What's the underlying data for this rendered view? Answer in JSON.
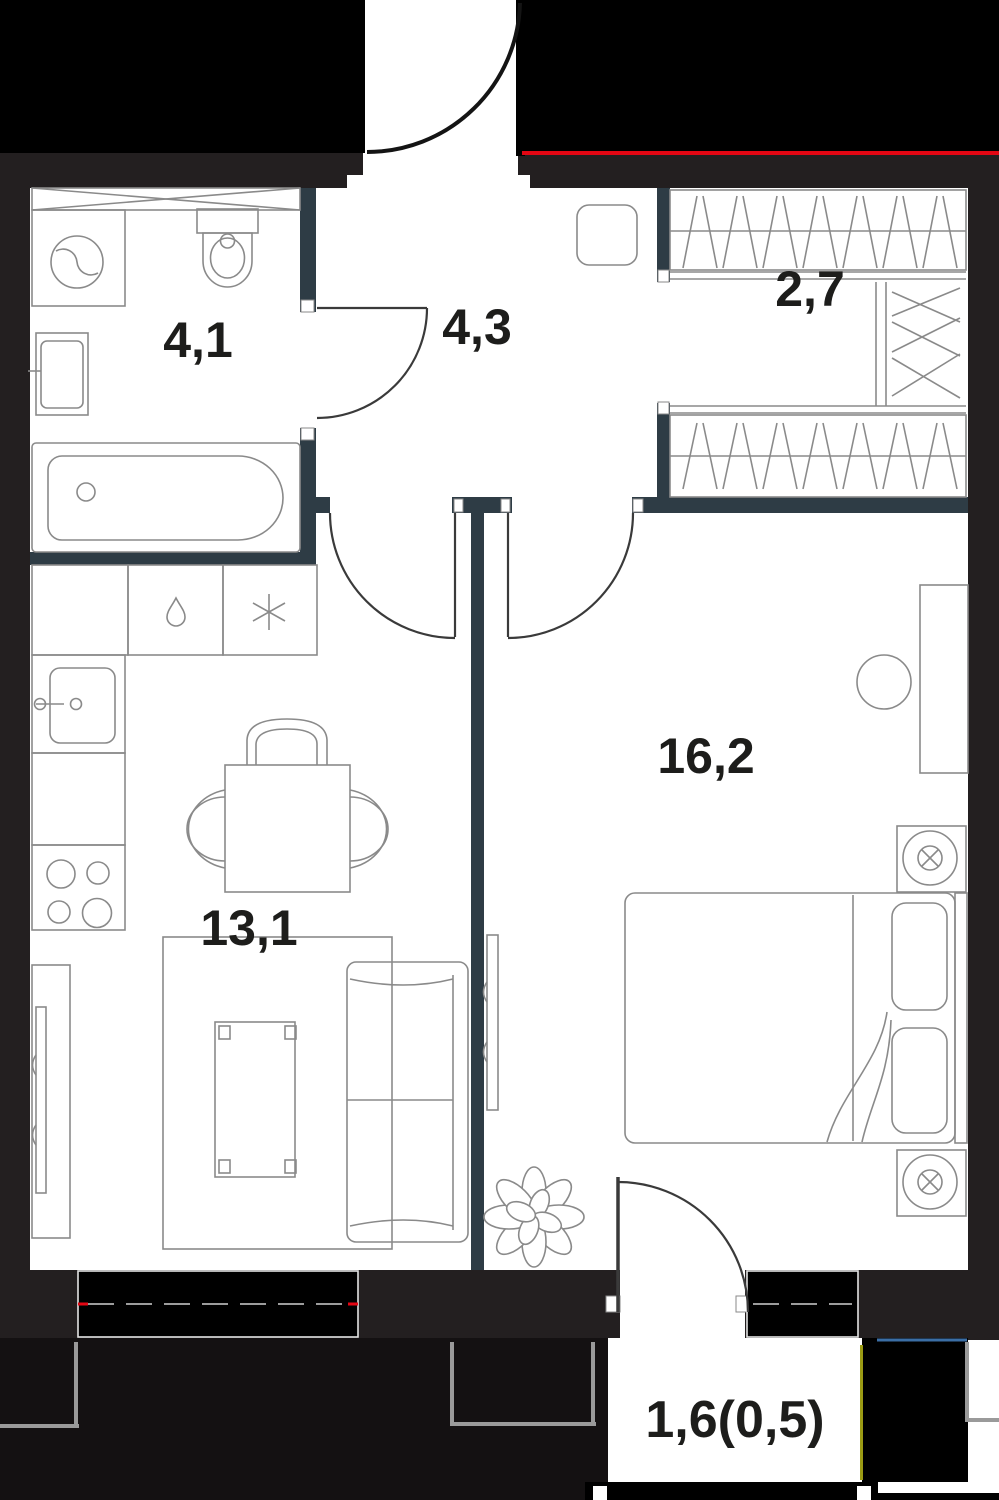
{
  "floor_plan": {
    "type": "apartment-floor-plan",
    "rooms": [
      {
        "name": "bathroom",
        "area_label": "4,1"
      },
      {
        "name": "hallway",
        "area_label": "4,3"
      },
      {
        "name": "wardrobe",
        "area_label": "2,7"
      },
      {
        "name": "bedroom",
        "area_label": "16,2"
      },
      {
        "name": "kitchen-living-room",
        "area_label": "13,1"
      },
      {
        "name": "balcony",
        "area_label": "1,6(0,5)"
      }
    ],
    "fixtures": [
      "ventilation-shaft",
      "washbasin",
      "toilet",
      "washing-machine",
      "bathtub",
      "kitchen-counter",
      "dishwasher-drop-icon",
      "fridge-snowflake-icon",
      "kitchen-sink",
      "stove",
      "dining-table",
      "chair",
      "rug",
      "coffee-table",
      "tv-console",
      "tv",
      "sofa",
      "plant",
      "bed",
      "pillow",
      "nightstand",
      "ceiling-lamp-icon",
      "desk",
      "stool",
      "wardrobe-rack",
      "door-swing"
    ],
    "colors": {
      "outside": "#000000",
      "exterior_wall": "#231f20",
      "partition_wall": "#2e3c45",
      "slab": "#141112",
      "furniture_line": "#8a8a8a",
      "door_line": "#3a3a3a",
      "entry_line": "#141414",
      "boundary_red": "#e30613",
      "boundary_blue": "#3b6ea5",
      "boundary_yellow": "#9b9b14",
      "facade_gray": "#9a9a9a",
      "window_frame": "#e3e3e3",
      "label_color": "#1d1d1b"
    }
  }
}
